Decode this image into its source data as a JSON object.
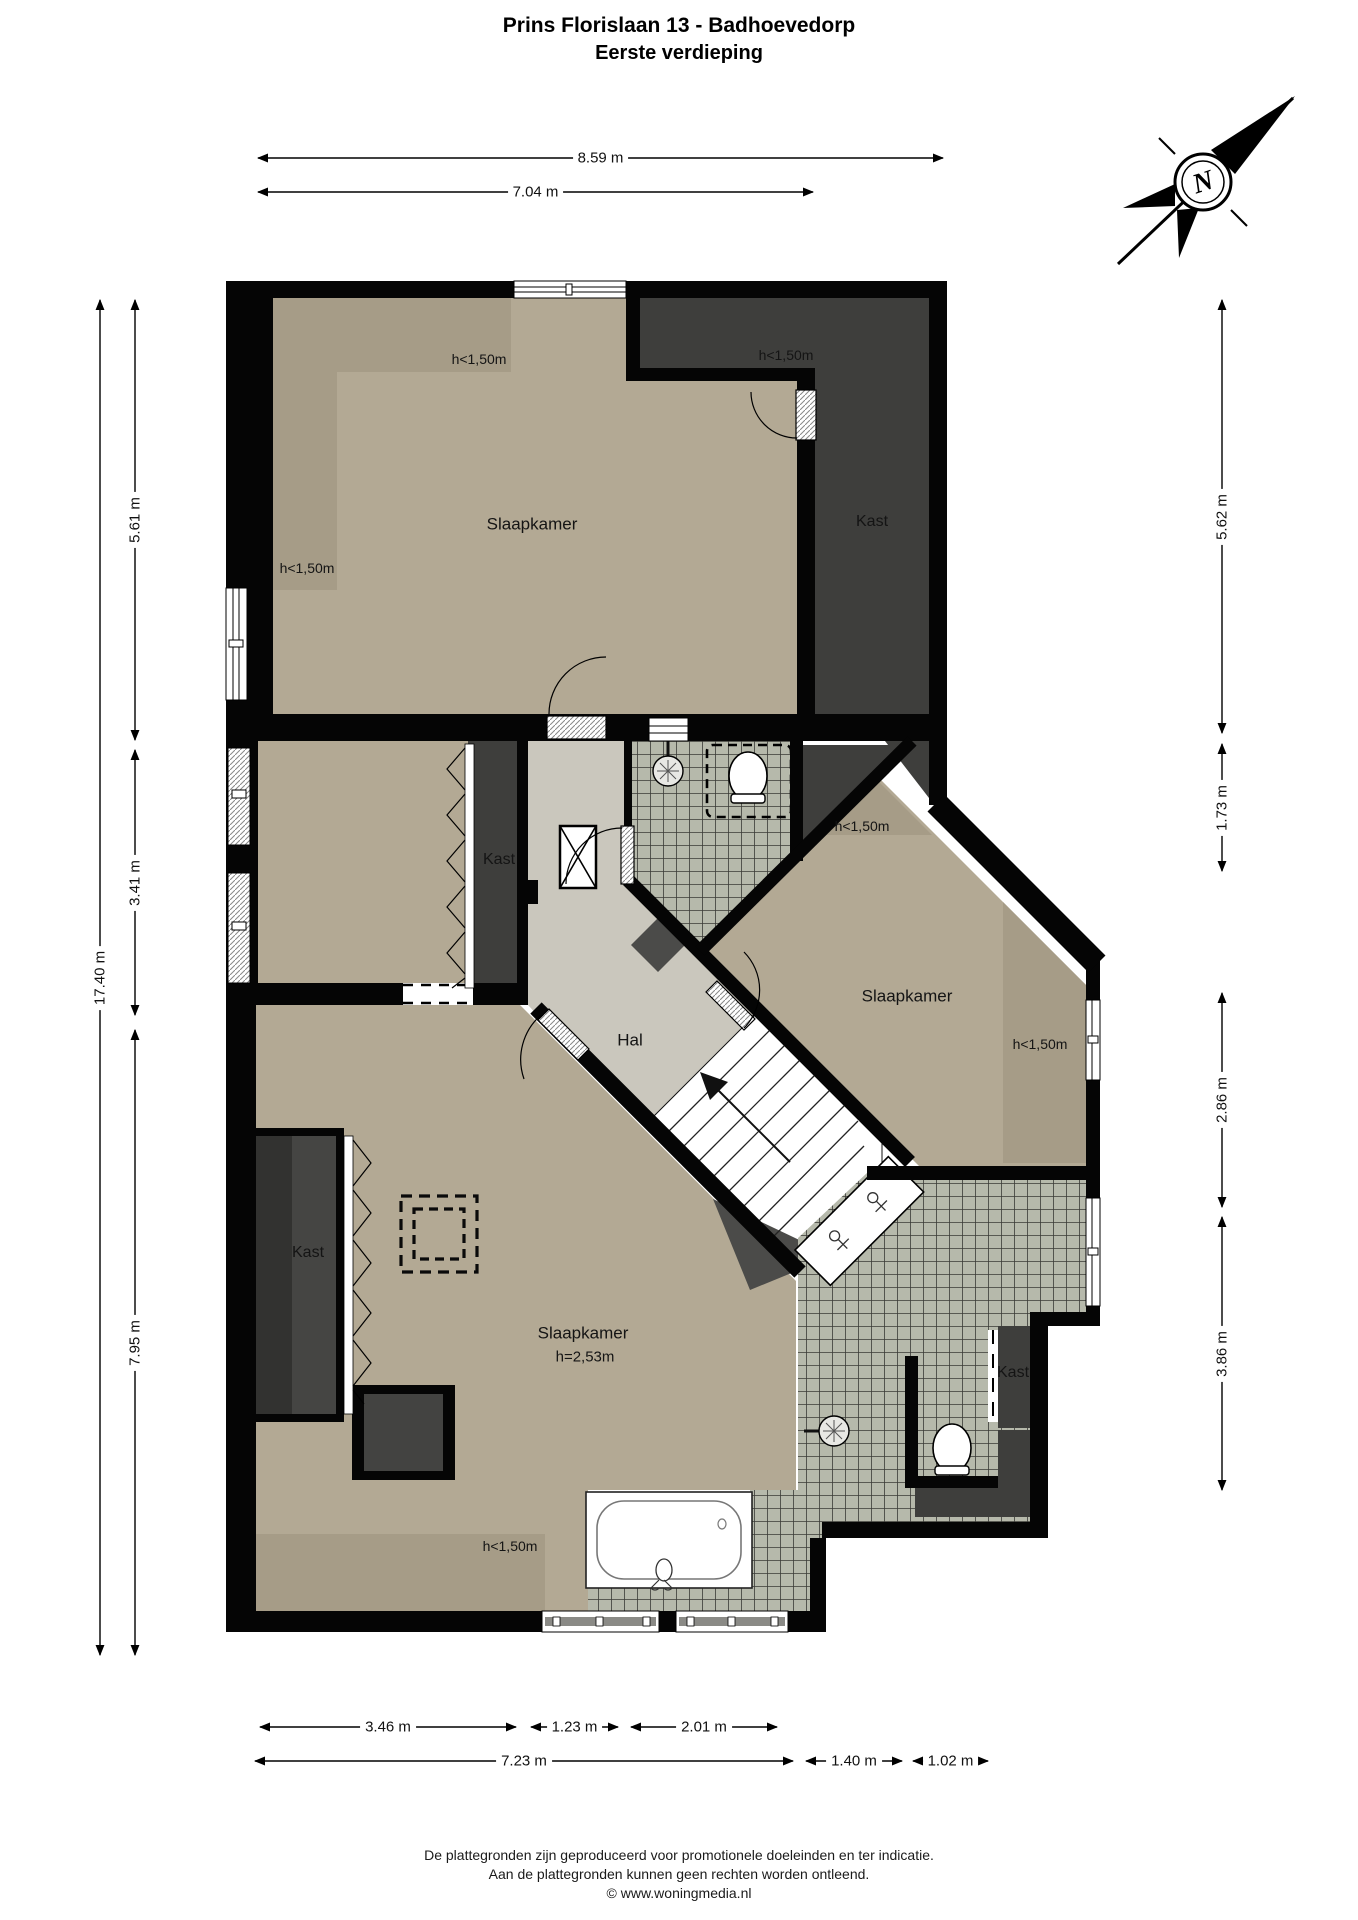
{
  "title": {
    "line1": "Prins Florislaan 13 - Badhoevedorp",
    "line2": "Eerste verdieping"
  },
  "compass": {
    "label": "N"
  },
  "colors": {
    "wall": "#050505",
    "room_light": "#b3a994",
    "room_sloped": "#a69c87",
    "closet_dark": "#3e3e3c",
    "hall_gray": "#cac7bd",
    "tile_fill": "#b6b9ab",
    "tile_line": "#3a3a36",
    "stair_white": "#ffffff",
    "wedge_dark": "#4b4b49"
  },
  "room_labels": [
    {
      "id": "room-label-slaapkamer-top",
      "text": "Slaapkamer",
      "x": 532,
      "y": 524,
      "size": 17
    },
    {
      "id": "room-label-kast-top-right",
      "text": "Kast",
      "x": 872,
      "y": 522,
      "size": 16
    },
    {
      "id": "room-label-kast-middle",
      "text": "Kast",
      "x": 499,
      "y": 860,
      "size": 16
    },
    {
      "id": "room-label-hal",
      "text": "Hal",
      "x": 630,
      "y": 1040,
      "size": 17
    },
    {
      "id": "room-label-slaapkamer-right",
      "text": "Slaapkamer",
      "x": 907,
      "y": 996,
      "size": 17
    },
    {
      "id": "room-label-kast-bottom-left",
      "text": "Kast",
      "x": 308,
      "y": 1253,
      "size": 16
    },
    {
      "id": "room-label-slaapkamer-bottom",
      "text": "Slaapkamer",
      "x": 583,
      "y": 1333,
      "size": 17
    },
    {
      "id": "room-label-height-253",
      "text": "h=2,53m",
      "x": 585,
      "y": 1357,
      "size": 15
    },
    {
      "id": "room-label-kast-bottom-right",
      "text": "Kast",
      "x": 1013,
      "y": 1373,
      "size": 16
    }
  ],
  "annotations": [
    {
      "id": "annotation-h150-top-left",
      "text": "h<1,50m",
      "x": 479,
      "y": 359,
      "size": 14
    },
    {
      "id": "annotation-h150-left",
      "text": "h<1,50m",
      "x": 307,
      "y": 568,
      "size": 14
    },
    {
      "id": "annotation-h150-top-right",
      "text": "h<1,50m",
      "x": 786,
      "y": 355,
      "size": 14
    },
    {
      "id": "annotation-h150-right-top",
      "text": "h<1,50m",
      "x": 862,
      "y": 826,
      "size": 14
    },
    {
      "id": "annotation-h150-right-side",
      "text": "h<1,50m",
      "x": 1040,
      "y": 1044,
      "size": 14
    },
    {
      "id": "annotation-h150-bottom",
      "text": "h<1,50m",
      "x": 510,
      "y": 1546,
      "size": 14
    }
  ],
  "dimensions": {
    "horizontal": [
      {
        "id": "dim-top-859",
        "label": "8.59 m",
        "x1": 258,
        "x2": 943,
        "y": 158
      },
      {
        "id": "dim-top-704",
        "label": "7.04 m",
        "x1": 258,
        "x2": 813,
        "y": 192
      },
      {
        "id": "dim-bottom-346",
        "label": "3.46 m",
        "x1": 260,
        "x2": 516,
        "y": 1727
      },
      {
        "id": "dim-bottom-123",
        "label": "1.23 m",
        "x1": 531,
        "x2": 618,
        "y": 1727
      },
      {
        "id": "dim-bottom-201",
        "label": "2.01 m",
        "x1": 631,
        "x2": 777,
        "y": 1727
      },
      {
        "id": "dim-bottom-723",
        "label": "7.23 m",
        "x1": 255,
        "x2": 793,
        "y": 1761
      },
      {
        "id": "dim-bottom-140",
        "label": "1.40 m",
        "x1": 806,
        "x2": 902,
        "y": 1761
      },
      {
        "id": "dim-bottom-102",
        "label": "1.02 m",
        "x1": 913,
        "x2": 988,
        "y": 1761
      }
    ],
    "vertical": [
      {
        "id": "dim-left-1740",
        "label": "17.40 m",
        "x": 100,
        "y1": 300,
        "y2": 1655
      },
      {
        "id": "dim-left-561",
        "label": "5.61 m",
        "x": 135,
        "y1": 300,
        "y2": 740
      },
      {
        "id": "dim-left-341",
        "label": "3.41 m",
        "x": 135,
        "y1": 750,
        "y2": 1015
      },
      {
        "id": "dim-left-795",
        "label": "7.95 m",
        "x": 135,
        "y1": 1030,
        "y2": 1655
      },
      {
        "id": "dim-right-562",
        "label": "5.62 m",
        "x": 1222,
        "y1": 300,
        "y2": 733
      },
      {
        "id": "dim-right-173",
        "label": "1.73 m",
        "x": 1222,
        "y1": 744,
        "y2": 871
      },
      {
        "id": "dim-right-286",
        "label": "2.86 m",
        "x": 1222,
        "y1": 993,
        "y2": 1207
      },
      {
        "id": "dim-right-386",
        "label": "3.86 m",
        "x": 1222,
        "y1": 1217,
        "y2": 1490
      }
    ]
  },
  "footer": {
    "line1": "De plattegronden zijn geproduceerd voor promotionele doeleinden en ter indicatie.",
    "line2": "Aan de plattegronden kunnen geen rechten worden ontleend.",
    "line3": "© www.woningmedia.nl"
  }
}
